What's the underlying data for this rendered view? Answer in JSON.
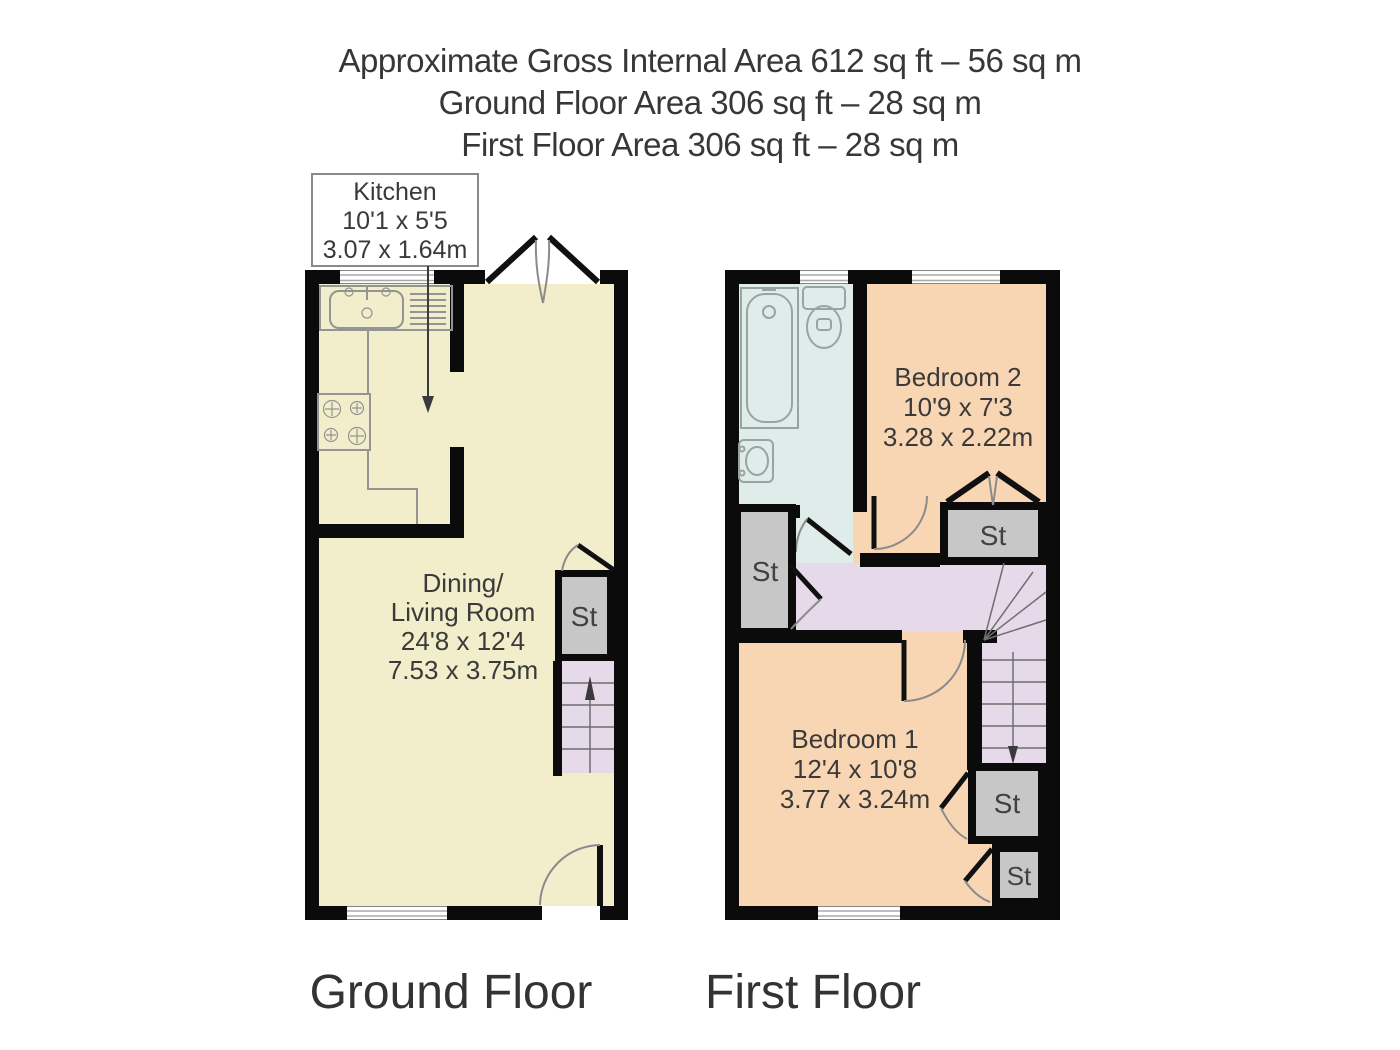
{
  "header": {
    "line1": "Approximate Gross Internal Area 612 sq ft – 56 sq m",
    "line2": "Ground Floor Area 306 sq ft – 28 sq m",
    "line3": "First Floor Area 306 sq ft – 28 sq m"
  },
  "ground_floor": {
    "caption": "Ground Floor",
    "kitchen_label": {
      "name": "Kitchen",
      "imperial": "10'1 x 5'5",
      "metric": "3.07 x 1.64m"
    },
    "living_room": {
      "line1": "Dining/",
      "line2": "Living Room",
      "imperial": "24'8 x 12'4",
      "metric": "7.53 x 3.75m"
    },
    "storage": "St"
  },
  "first_floor": {
    "caption": "First Floor",
    "bedroom2": {
      "name": "Bedroom 2",
      "imperial": "10'9 x 7'3",
      "metric": "3.28 x 2.22m"
    },
    "bedroom1": {
      "name": "Bedroom 1",
      "imperial": "12'4 x 10'8",
      "metric": "3.77 x 3.24m"
    },
    "storage": "St"
  },
  "palette": {
    "wall_black": "#0b0b0b",
    "floor_cream": "#f2edca",
    "bedroom_peach": "#f8d6b4",
    "bathroom_blue": "#e0ece9",
    "stairs_lavender": "#e6d9e9",
    "storage_grey": "#c7c7c7",
    "text_dark": "#3a3a3a"
  }
}
